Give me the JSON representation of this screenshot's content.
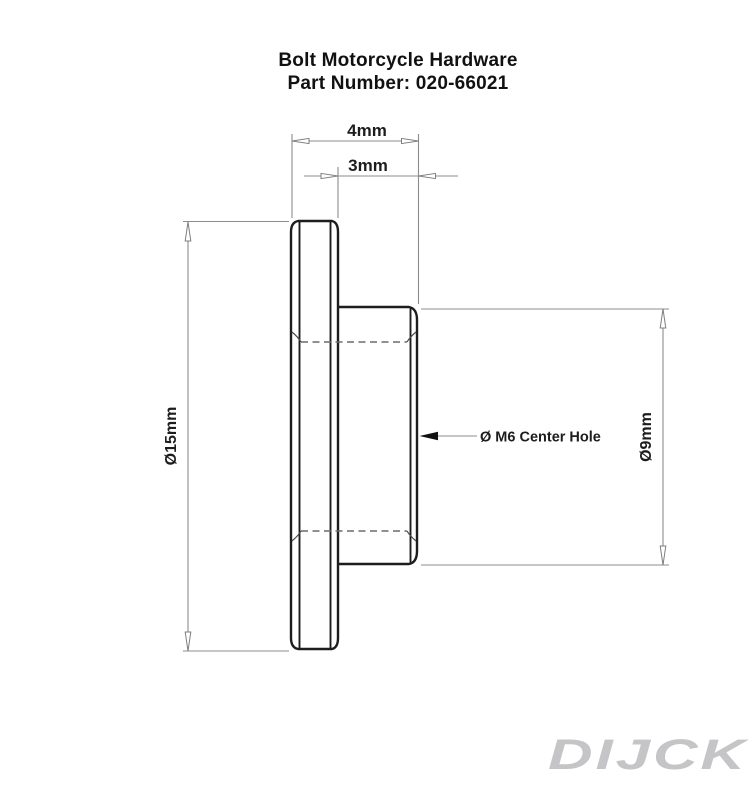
{
  "title": {
    "line1": "Bolt Motorcycle Hardware",
    "line2": "Part Number: 020-66021"
  },
  "dimensions": {
    "overall_length": "4mm",
    "boss_length": "3mm",
    "flange_diameter": "Ø15mm",
    "boss_diameter": "Ø9mm"
  },
  "labels": {
    "center_hole": "Ø M6 Center Hole"
  },
  "watermark": "DIJCK",
  "colors": {
    "background": "#ffffff",
    "part_line": "#1d1d1d",
    "dimension_line": "#8c8c8c",
    "hidden_line": "#6b6b6b",
    "watermark": "#c5c5c7"
  }
}
